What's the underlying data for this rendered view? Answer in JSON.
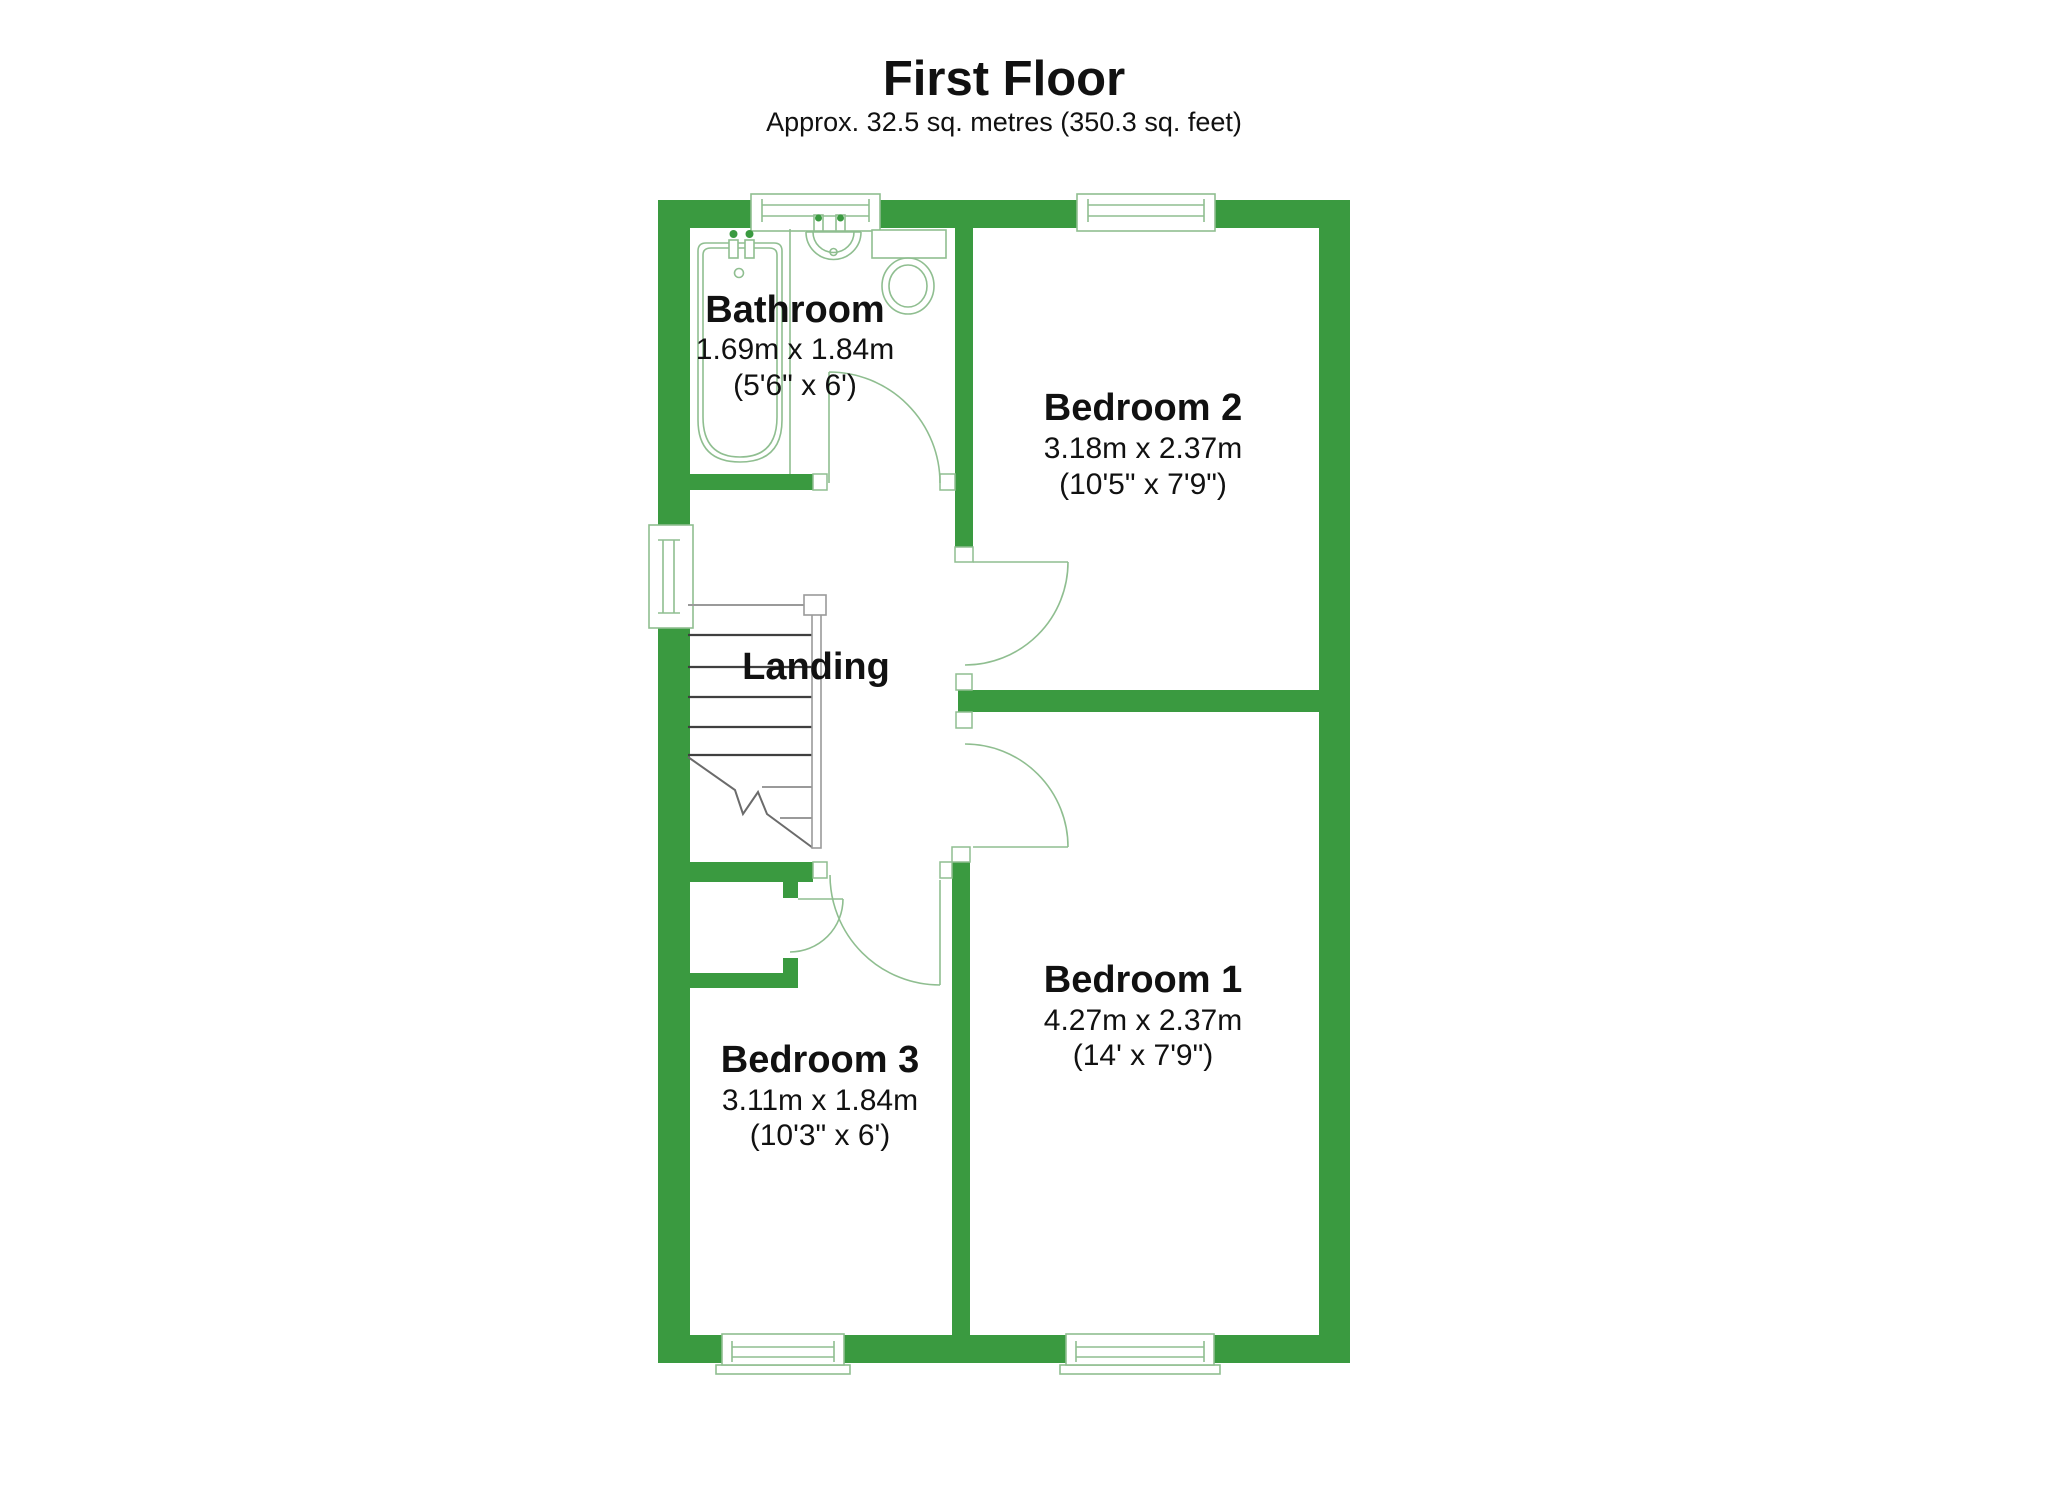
{
  "title": "First Floor",
  "subtitle": "Approx. 32.5 sq. metres (350.3 sq. feet)",
  "colors": {
    "wall": "#3a9a40",
    "fixture": "#8fbe90",
    "stair": "#3f3f3f",
    "stairmid": "#6b6b6b",
    "stairlight": "#9a9a9a",
    "text": "#111111"
  },
  "rooms": {
    "bathroom": {
      "name": "Bathroom",
      "metric": "1.69m x 1.84m",
      "imperial": "(5'6\" x 6')"
    },
    "bedroom2": {
      "name": "Bedroom 2",
      "metric": "3.18m x 2.37m",
      "imperial": "(10'5\" x 7'9\")"
    },
    "landing": {
      "name": "Landing"
    },
    "bedroom1": {
      "name": "Bedroom 1",
      "metric": "4.27m x 2.37m",
      "imperial": "(14' x 7'9\")"
    },
    "bedroom3": {
      "name": "Bedroom 3",
      "metric": "3.11m x 1.84m",
      "imperial": "(10'3\" x 6')"
    }
  }
}
